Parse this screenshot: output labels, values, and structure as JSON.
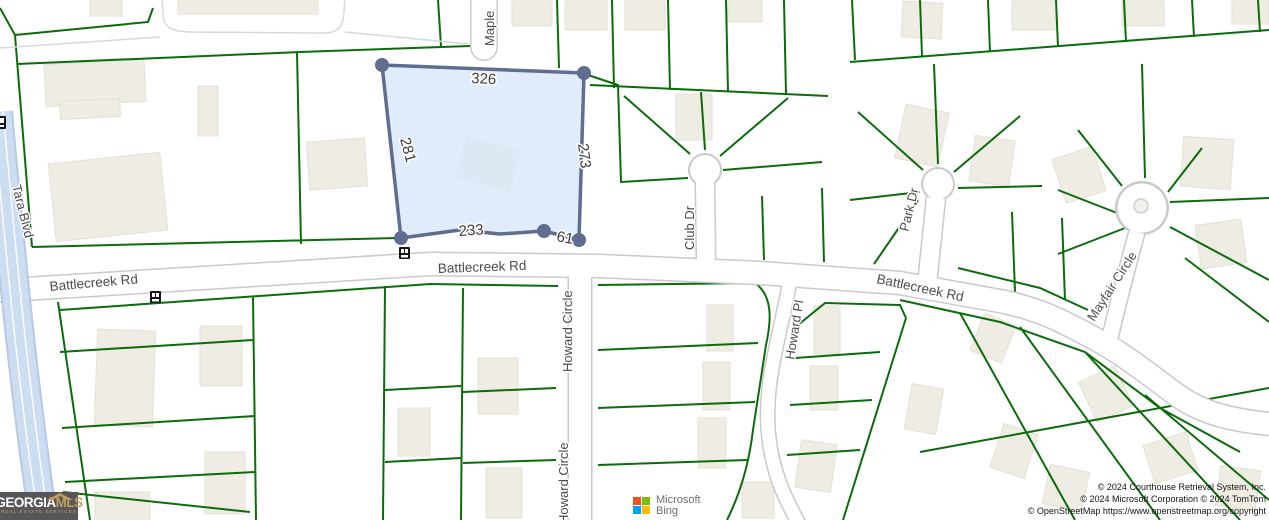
{
  "map": {
    "street_labels": {
      "maple": "Maple",
      "battlecreek_left": "Battlecreek Rd",
      "battlecreek_center": "Battlecreek Rd",
      "battlecreek_right": "Battlecreek Rd",
      "howard_circle_upper": "Howard Circle",
      "howard_circle_lower": "Howard Circle",
      "club_dr": "Club Dr",
      "howard_pl": "Howard Pl",
      "park_dr": "Park Dr",
      "mayfair_circle": "Mayfair Circle",
      "tara_blvd": "Tara Blvd"
    },
    "subject_parcel": {
      "dimensions": {
        "top": "326",
        "left": "281",
        "right": "273",
        "bottom": "233",
        "bottom_right": "61"
      },
      "fill": "#d9e7f8",
      "outline": "#5f6e90"
    },
    "colors": {
      "parcel_lines": "#0a6c0a",
      "road_casing": "#c9c9c9",
      "road_fill": "#ffffff",
      "highway_casing": "#b7c9e4",
      "highway_fill": "#ccddf1",
      "building_fill": "#efece3",
      "building_stroke": "#e3e0d6",
      "background": "#ffffff"
    }
  },
  "branding": {
    "georgia_mls": {
      "name_part1": "GEORGIA",
      "name_part2": "MLS",
      "tagline": "REAL ESTATE SERVICES",
      "bg_color": "#57575a",
      "accent_color": "#c2a05c",
      "text_color": "#ffffff"
    },
    "microsoft_bing": {
      "line1": "Microsoft",
      "line2": "Bing",
      "square_colors": {
        "top_left": "#f25022",
        "top_right": "#7fba00",
        "bottom_left": "#00a4ef",
        "bottom_right": "#ffb900"
      }
    }
  },
  "attribution": {
    "line1": "© 2024 Courthouse Retrieval System, Inc.",
    "line2": "© 2024 Microsoft Corporation © 2024 TomTom",
    "line3": "© OpenStreetMap https://www.openstreetmap.org/copyright"
  }
}
